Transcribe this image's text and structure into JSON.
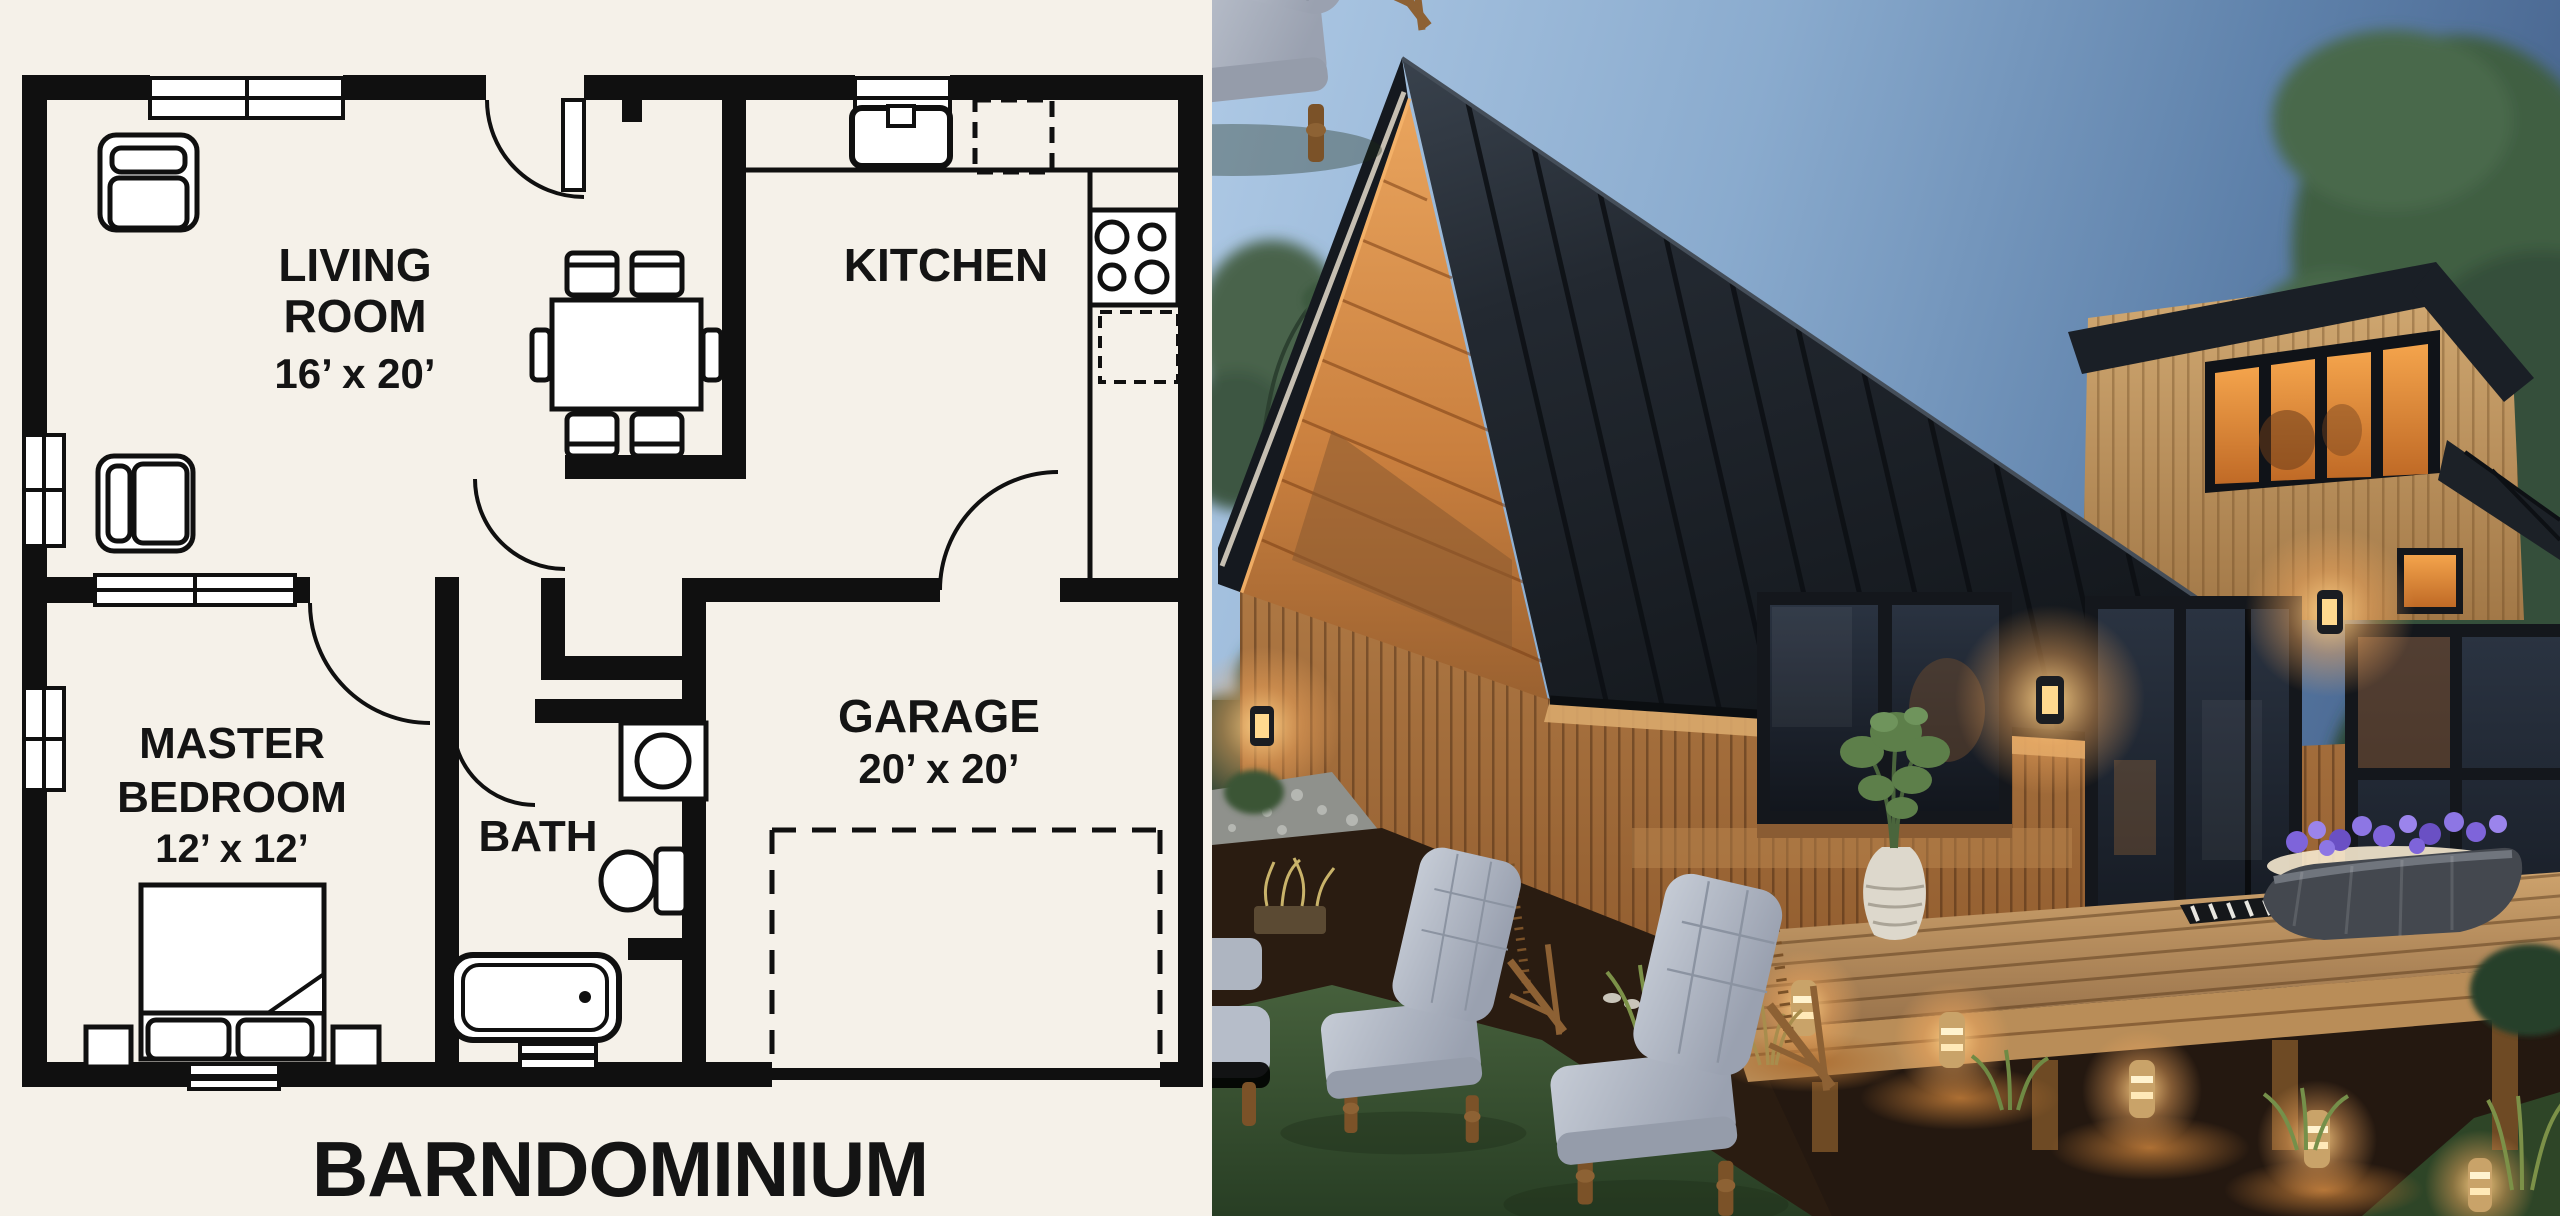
{
  "meta": {
    "composition": "split image: floor plan left, exterior photo right"
  },
  "floor_plan": {
    "title": "BARNDOMINIUM",
    "rooms": {
      "living_room": {
        "line1": "LIVING",
        "line2": "ROOM",
        "dims": "16’ x 20’"
      },
      "kitchen": {
        "label": "KITCHEN"
      },
      "master_bedroom": {
        "line1": "MASTER",
        "line2": "BEDROOM",
        "dims": "12’ x 12’"
      },
      "bath": {
        "label": "BATH"
      },
      "garage": {
        "label": "GARAGE",
        "dims": "20’ x 20’"
      }
    },
    "colors": {
      "paper": "#f5f1e9",
      "ink": "#101010"
    }
  },
  "photo": {
    "scene": "wood barndominium exterior at dusk",
    "colors": {
      "sky_light": "#aec9e5",
      "sky_deep": "#47648e",
      "roof_black": "#232931",
      "cedar_wood": "#a5713e",
      "soffit_glow": "#e09a55",
      "window_glow": "#e8913f",
      "deck_wood": "#c59a66",
      "cushion_gray": "#b6bdc9",
      "grass_dusk": "#3c5634",
      "flower_purple": "#7e64da"
    }
  }
}
